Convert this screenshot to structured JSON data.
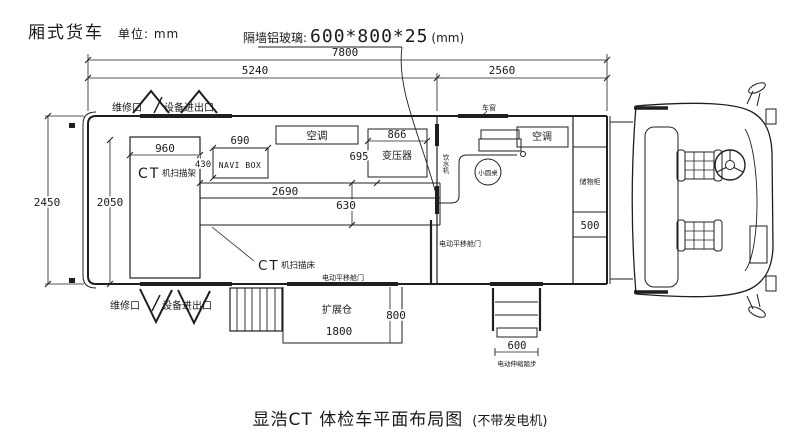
{
  "header": {
    "vehicle_type": "厢式货车",
    "unit": "单位: mm",
    "glass_label": "隔墙铝玻璃:",
    "glass_value": "600*800*25",
    "glass_unit": "(mm)"
  },
  "dims": {
    "d7800": "7800",
    "d5240": "5240",
    "d2560": "2560",
    "d2450": "2450",
    "d2050": "2050",
    "d960": "960",
    "d690": "690",
    "d430": "430",
    "d866": "866",
    "d695": "695",
    "d2690": "2690",
    "d630": "630",
    "d500": "500",
    "d800": "800",
    "d1800": "1800",
    "d600": "600"
  },
  "labels": {
    "service_port": "维修口",
    "equipment_port": "设备进出口",
    "ct": "CT",
    "gantry_suffix": "机扫描架",
    "bed_suffix": "机扫描床",
    "navi_box": "NAVI BOX",
    "air_conditioner": "空调",
    "transformer": "变压器",
    "sliding_door": "电动平移舱门",
    "expansion_bay": "扩展仓",
    "round_table": "小圆桌",
    "window": "车窗",
    "water_dispenser": "饮水机",
    "storage_cabinet": "储物柜",
    "retract_steps": "电动伸缩踏步"
  },
  "footer": {
    "title": "显浩CT 体检车平面布局图",
    "note": "(不带发电机)"
  },
  "colors": {
    "line": "#1f1f1f",
    "background": "#ffffff"
  }
}
